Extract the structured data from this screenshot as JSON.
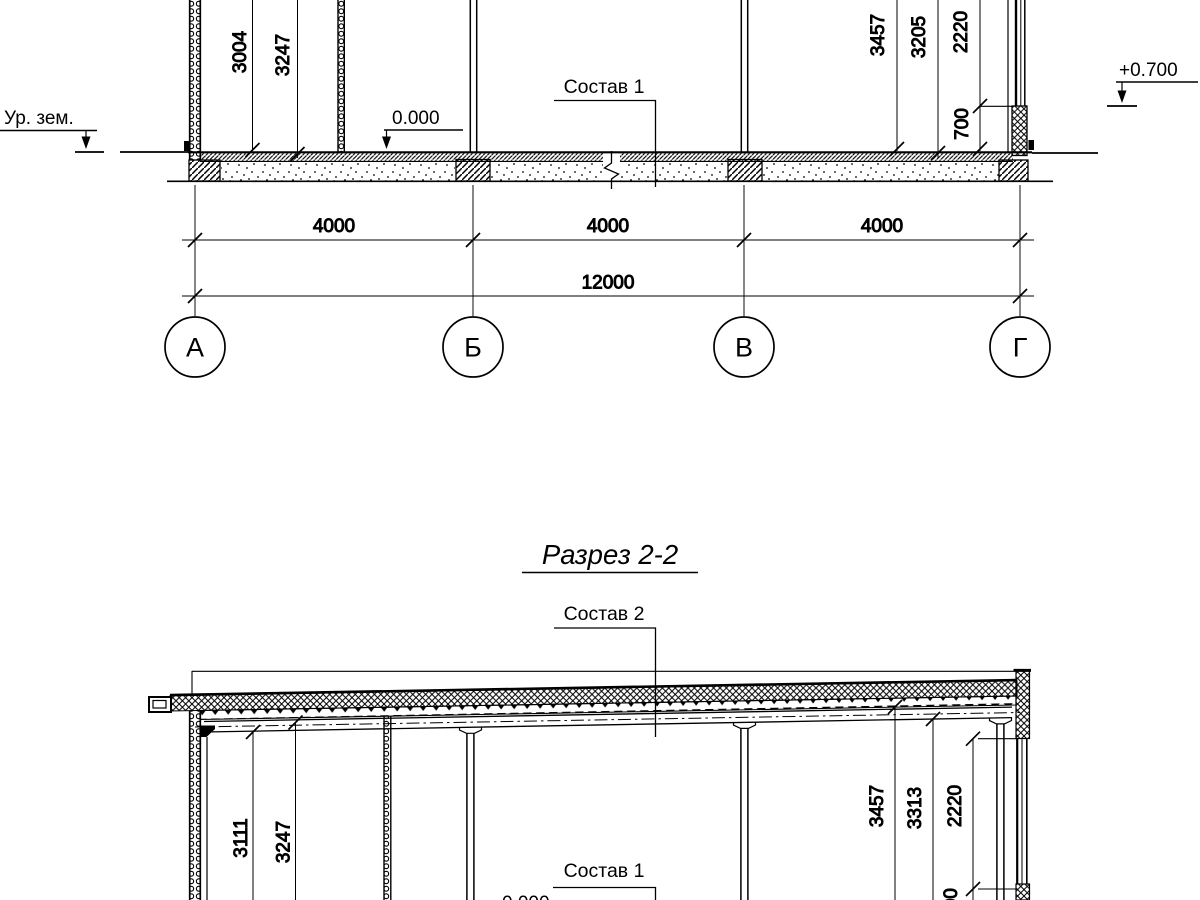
{
  "drawing": {
    "background_color": "#ffffff",
    "line_color": "#000000",
    "title": "Разрез 2-2",
    "section_1": {
      "ground_level_label": "Ур. зем.",
      "zero_level_mark": "0.000",
      "floor_composition_label": "Состав 1",
      "right_ground_level_mark": "+0.700",
      "height_dims_left": [
        "3004",
        "3247"
      ],
      "height_dims_right": [
        "3457",
        "3205",
        "2220",
        "700"
      ],
      "span_dims": [
        "4000",
        "4000",
        "4000"
      ],
      "overall_dim": "12000",
      "axis_marks": [
        "А",
        "Б",
        "В",
        "Г"
      ]
    },
    "section_2": {
      "roof_composition_label": "Состав 2",
      "floor_composition_label": "Состав 1",
      "zero_level_mark": "0.000",
      "height_dims_left": [
        "3111",
        "3247"
      ],
      "height_dims_right": [
        "3457",
        "3313",
        "2220",
        "700"
      ]
    }
  }
}
